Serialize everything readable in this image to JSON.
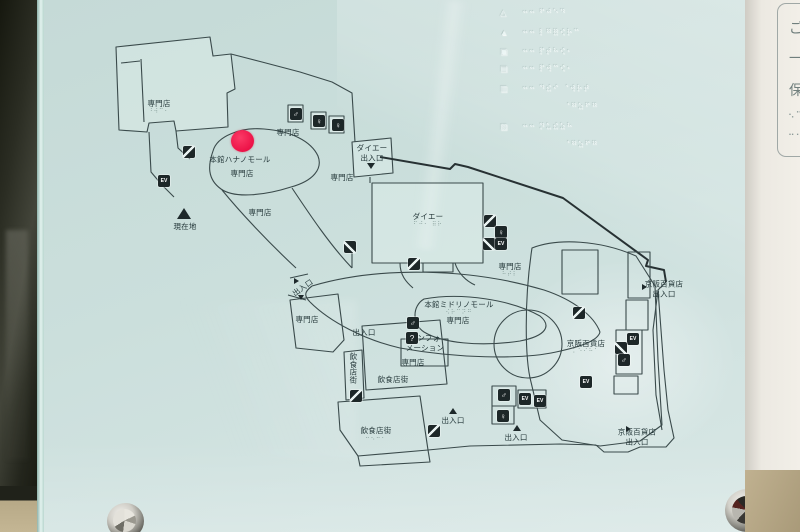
{
  "panel": {
    "glass_color": "#cbdfdc",
    "line_color": "#3a4a4b",
    "red_dot": {
      "x": 242,
      "y": 141,
      "color": "#ec1247"
    }
  },
  "map": {
    "labels": [
      {
        "text": "専門店",
        "x": 159,
        "y": 107,
        "braille": "⠘⠺⠉⠂"
      },
      {
        "text": "専門店",
        "x": 288,
        "y": 133
      },
      {
        "text": "本館ハナノモール",
        "x": 240,
        "y": 160
      },
      {
        "text": "専門店",
        "x": 242,
        "y": 174
      },
      {
        "text": "専門店",
        "x": 260,
        "y": 213
      },
      {
        "text": "専門店",
        "x": 342,
        "y": 178
      },
      {
        "text": "ダイエー\n出入口",
        "x": 372,
        "y": 153
      },
      {
        "text": "ダイエー",
        "x": 428,
        "y": 220,
        "braille": "⠋⠚⠂ ⠿⠗"
      },
      {
        "text": "専門店",
        "x": 510,
        "y": 270,
        "braille": "⠓⠞⠇"
      },
      {
        "text": "出入口",
        "x": 303,
        "y": 288,
        "rot": -35
      },
      {
        "text": "専門店",
        "x": 307,
        "y": 320
      },
      {
        "text": "出入口",
        "x": 364,
        "y": 333
      },
      {
        "text": "本館ミドリノモール",
        "x": 459,
        "y": 308,
        "braille": "⠪⠗⠉⠝⠛"
      },
      {
        "text": "専門店",
        "x": 458,
        "y": 321
      },
      {
        "text": "インフォ\nメーション",
        "x": 425,
        "y": 343
      },
      {
        "text": "専門店",
        "x": 413,
        "y": 363
      },
      {
        "text": "飲食店街",
        "x": 393,
        "y": 380
      },
      {
        "text": "飲食店街",
        "x": 376,
        "y": 434,
        "braille": "⠒⠢⠒⠂"
      },
      {
        "text": "出入口",
        "x": 453,
        "y": 421
      },
      {
        "text": "出入口",
        "x": 516,
        "y": 438
      },
      {
        "text": "京阪百貨店\n出入口",
        "x": 664,
        "y": 289
      },
      {
        "text": "京阪百貨店",
        "x": 586,
        "y": 347,
        "braille": "⠅⠑⠊⠓⠁"
      },
      {
        "text": "京阪百貨店\n出入口",
        "x": 637,
        "y": 437
      },
      {
        "text": "現在地",
        "x": 185,
        "y": 227
      }
    ],
    "vertical_labels": [
      {
        "text": "飲食店街",
        "x": 353,
        "y": 368
      }
    ],
    "icons": [
      {
        "type": "toilet-men",
        "x": 296,
        "y": 114
      },
      {
        "type": "toilet-women",
        "x": 319,
        "y": 121
      },
      {
        "type": "toilet-women",
        "x": 338,
        "y": 125
      },
      {
        "type": "escalator",
        "x": 189,
        "y": 152
      },
      {
        "type": "elevator",
        "x": 164,
        "y": 181
      },
      {
        "type": "stairs",
        "x": 350,
        "y": 247
      },
      {
        "type": "escalator",
        "x": 414,
        "y": 264
      },
      {
        "type": "escalator",
        "x": 490,
        "y": 221
      },
      {
        "type": "toilet-women",
        "x": 501,
        "y": 232
      },
      {
        "type": "stairs",
        "x": 489,
        "y": 244
      },
      {
        "type": "elevator",
        "x": 501,
        "y": 244
      },
      {
        "type": "toilet-men",
        "x": 413,
        "y": 323
      },
      {
        "type": "info",
        "x": 412,
        "y": 338
      },
      {
        "type": "escalator",
        "x": 356,
        "y": 396
      },
      {
        "type": "escalator",
        "x": 579,
        "y": 313
      },
      {
        "type": "elevator",
        "x": 586,
        "y": 382
      },
      {
        "type": "toilet-men",
        "x": 504,
        "y": 395
      },
      {
        "type": "elevator",
        "x": 525,
        "y": 399
      },
      {
        "type": "elevator",
        "x": 540,
        "y": 401
      },
      {
        "type": "toilet-women",
        "x": 503,
        "y": 416
      },
      {
        "type": "escalator",
        "x": 434,
        "y": 431
      },
      {
        "type": "elevator",
        "x": 633,
        "y": 339
      },
      {
        "type": "stairs",
        "x": 621,
        "y": 348
      },
      {
        "type": "toilet-men",
        "x": 624,
        "y": 360
      }
    ],
    "markers": [
      {
        "dir": "up",
        "x": 184,
        "y": 213,
        "size": 11,
        "name": "current-location"
      },
      {
        "dir": "down",
        "x": 371,
        "y": 166,
        "size": 6,
        "name": "daiei-entrance"
      },
      {
        "dir": "right",
        "x": 297,
        "y": 280,
        "size": 5,
        "name": "entrance"
      },
      {
        "dir": "down",
        "x": 301,
        "y": 297,
        "size": 5,
        "name": "entrance"
      },
      {
        "dir": "up",
        "x": 453,
        "y": 411,
        "size": 6,
        "name": "entrance"
      },
      {
        "dir": "up",
        "x": 517,
        "y": 428,
        "size": 6,
        "name": "entrance"
      },
      {
        "dir": "right",
        "x": 645,
        "y": 286,
        "size": 5,
        "name": "keihan-entrance"
      },
      {
        "dir": "right",
        "x": 629,
        "y": 428,
        "size": 5,
        "name": "keihan-entrance"
      }
    ]
  },
  "legend": {
    "rows": [
      {
        "symbol": "△",
        "dots": "⠒⠒ ⠋⠚⠑⠙",
        "top": 8,
        "indent": 0
      },
      {
        "symbol": "▲",
        "dots": "⠒⠒ ⠇⠛⠿⠪⠗⠉",
        "top": 28,
        "indent": 0
      },
      {
        "symbol": "▣",
        "dots": "⠒⠒ ⠏⠞⠓⠪⠂",
        "top": 47,
        "indent": 0
      },
      {
        "symbol": "▤",
        "dots": "⠒⠒ ⠏⠺⠉⠪⠂",
        "top": 64,
        "indent": 0
      },
      {
        "symbol": "▥",
        "dots": "⠒⠒ ⠙⠮⠊ ⠈⠺⠗⠞",
        "top": 84,
        "indent": 0
      },
      {
        "symbol": "",
        "dots": "⠈⠛⠵⠋⠛",
        "top": 102,
        "indent": 42
      },
      {
        "symbol": "▧",
        "dots": "⠒⠒ ⠝⠥⠮⠵⠓",
        "top": 122,
        "indent": 0
      },
      {
        "symbol": "",
        "dots": "⠈⠛⠵⠋⠛",
        "top": 140,
        "indent": 42
      }
    ]
  },
  "side_sign": {
    "chars": [
      {
        "ch": "ご",
        "top": 14
      },
      {
        "ch": "一",
        "top": 44
      },
      {
        "ch": "保",
        "top": 76
      },
      {
        "ch": "⠢⠉",
        "top": 106,
        "dots": true
      },
      {
        "ch": "⠒⠂",
        "top": 126,
        "dots": true
      }
    ]
  }
}
